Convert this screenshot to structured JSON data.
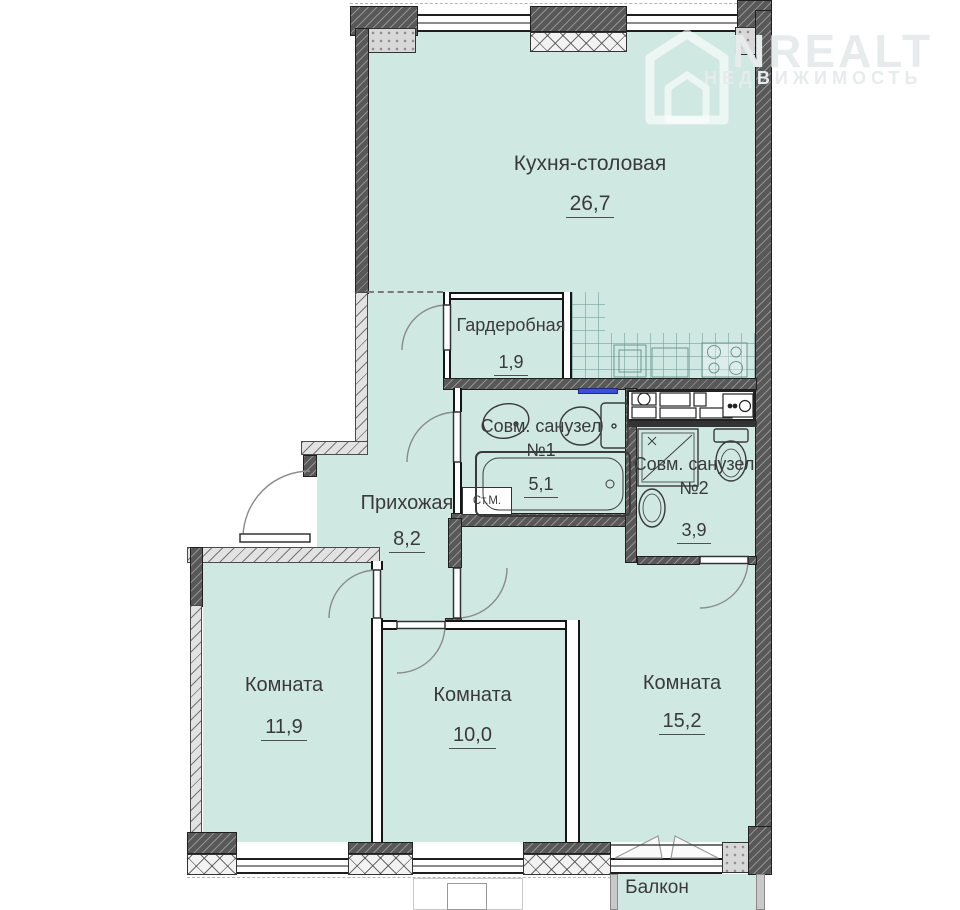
{
  "plan": {
    "watermark": {
      "brand": "ONREALT",
      "brand_text": "NREALT",
      "subtitle": "НЕДВИЖИМОСТЬ"
    },
    "rooms": [
      {
        "key": "kitchen",
        "name": "Кухня-столовая",
        "area": "26,7"
      },
      {
        "key": "wardrobe",
        "name": "Гардеробная",
        "area": "1,9"
      },
      {
        "key": "bath1",
        "name": "Совм. санузел №1",
        "area": "5,1"
      },
      {
        "key": "bath2",
        "name": "Совм. санузел №2",
        "area": "3,9"
      },
      {
        "key": "hallway",
        "name": "Прихожая",
        "area": "8,2"
      },
      {
        "key": "room-left",
        "name": "Комната",
        "area": "11,9"
      },
      {
        "key": "room-middle",
        "name": "Комната",
        "area": "10,0"
      },
      {
        "key": "room-right",
        "name": "Комната",
        "area": "15,2"
      },
      {
        "key": "balcony",
        "name": "Балкон",
        "area": ""
      }
    ],
    "fixtures": {
      "washing_machine": "Ст.М."
    },
    "colors": {
      "floor": "#cfe8e2",
      "wall_dark": "#585858",
      "accent_blue": "#3b4fd8"
    }
  }
}
